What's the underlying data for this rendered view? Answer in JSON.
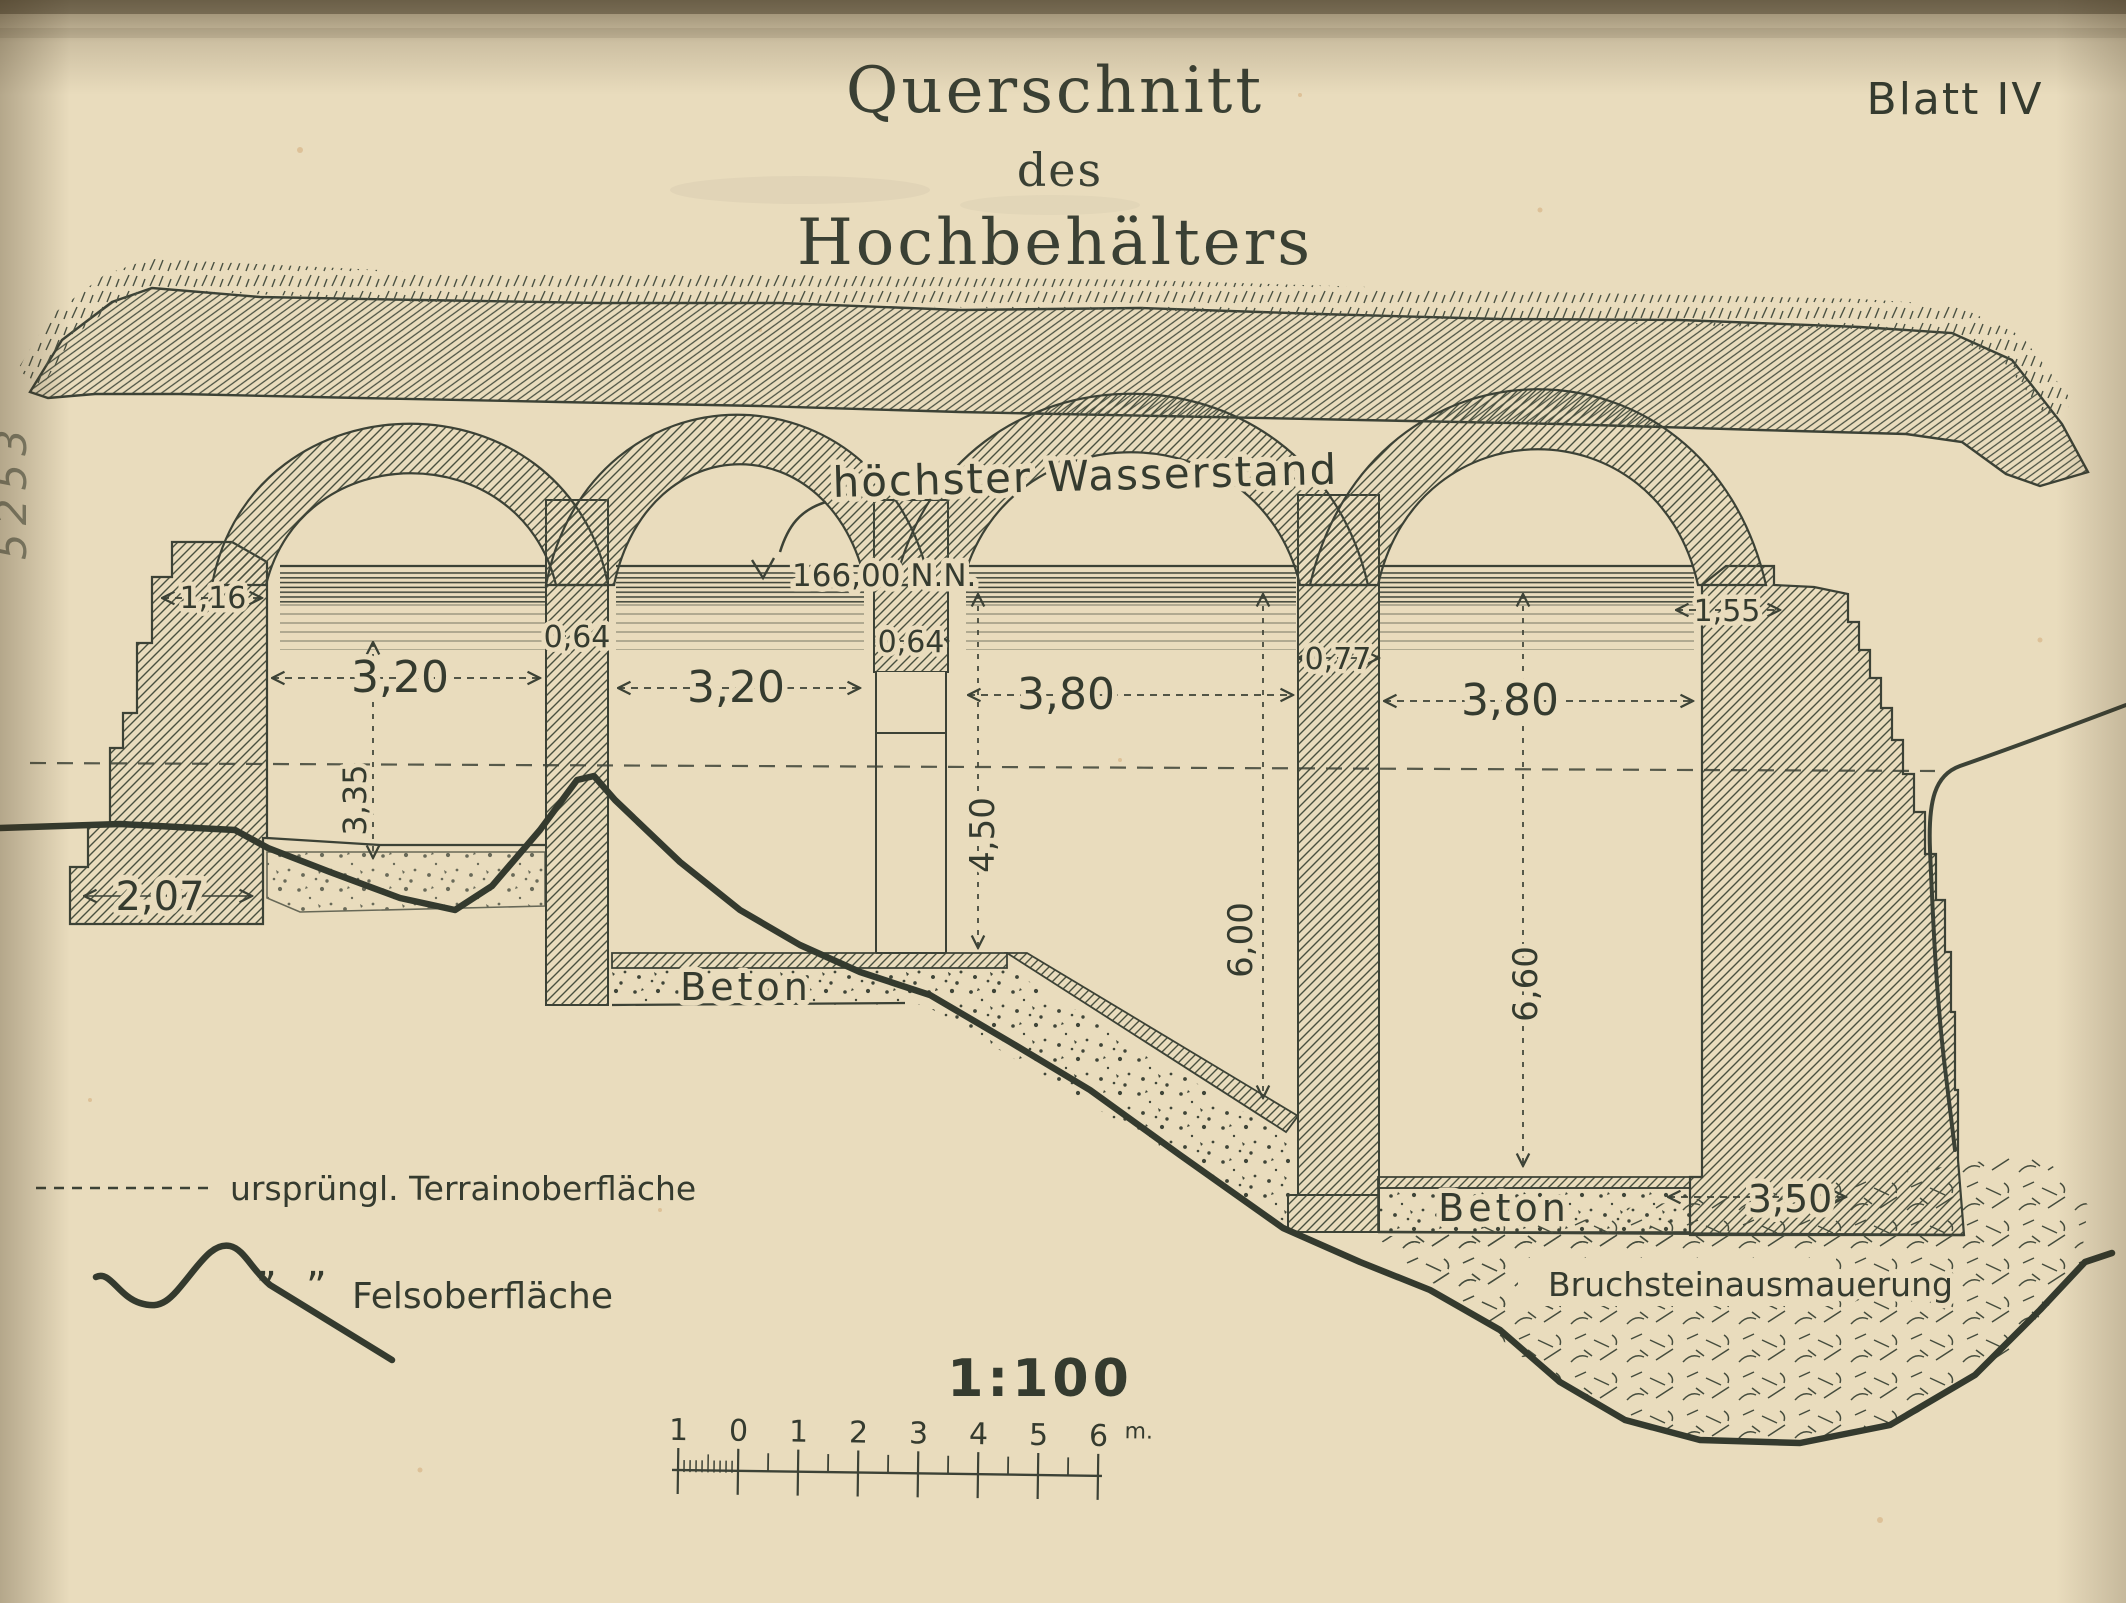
{
  "document": {
    "sheet_label": "Blatt IV",
    "title_line1": "Querschnitt",
    "title_line2": "des",
    "title_line3": "Hochbehälters",
    "margin_note": "5253",
    "scale_ratio": "1:100",
    "scale_unit": "m.",
    "scale_ticks": [
      "1",
      "0",
      "1",
      "2",
      "3",
      "4",
      "5",
      "6"
    ]
  },
  "annotations": {
    "water_label": "höchster Wasserstand",
    "water_level": "166,00 N.N.",
    "beton_left": "Beton",
    "beton_right": "Beton",
    "rubble_masonry": "Bruchsteinausmauerung"
  },
  "dimensions": {
    "left_wall_top": "1,16",
    "chamber1_width": "3,20",
    "pier1": "0,64",
    "chamber2_width": "3,20",
    "pier2": "0,64",
    "chamber3_width": "3,80",
    "pier3": "0,77",
    "chamber4_width": "3,80",
    "right_wall_top": "1,55",
    "chamber1_depth": "3,35",
    "left_footing": "2,07",
    "chamber2_depth": "4,50",
    "chamber3_depth": "6,00",
    "chamber4_depth": "6,60",
    "right_footing": "3,50"
  },
  "legend": {
    "terrain_label": "ursprüngl. Terrainoberfläche",
    "ditto_left": "”",
    "ditto_right": "”",
    "rock_label": "Felsoberfläche"
  }
}
